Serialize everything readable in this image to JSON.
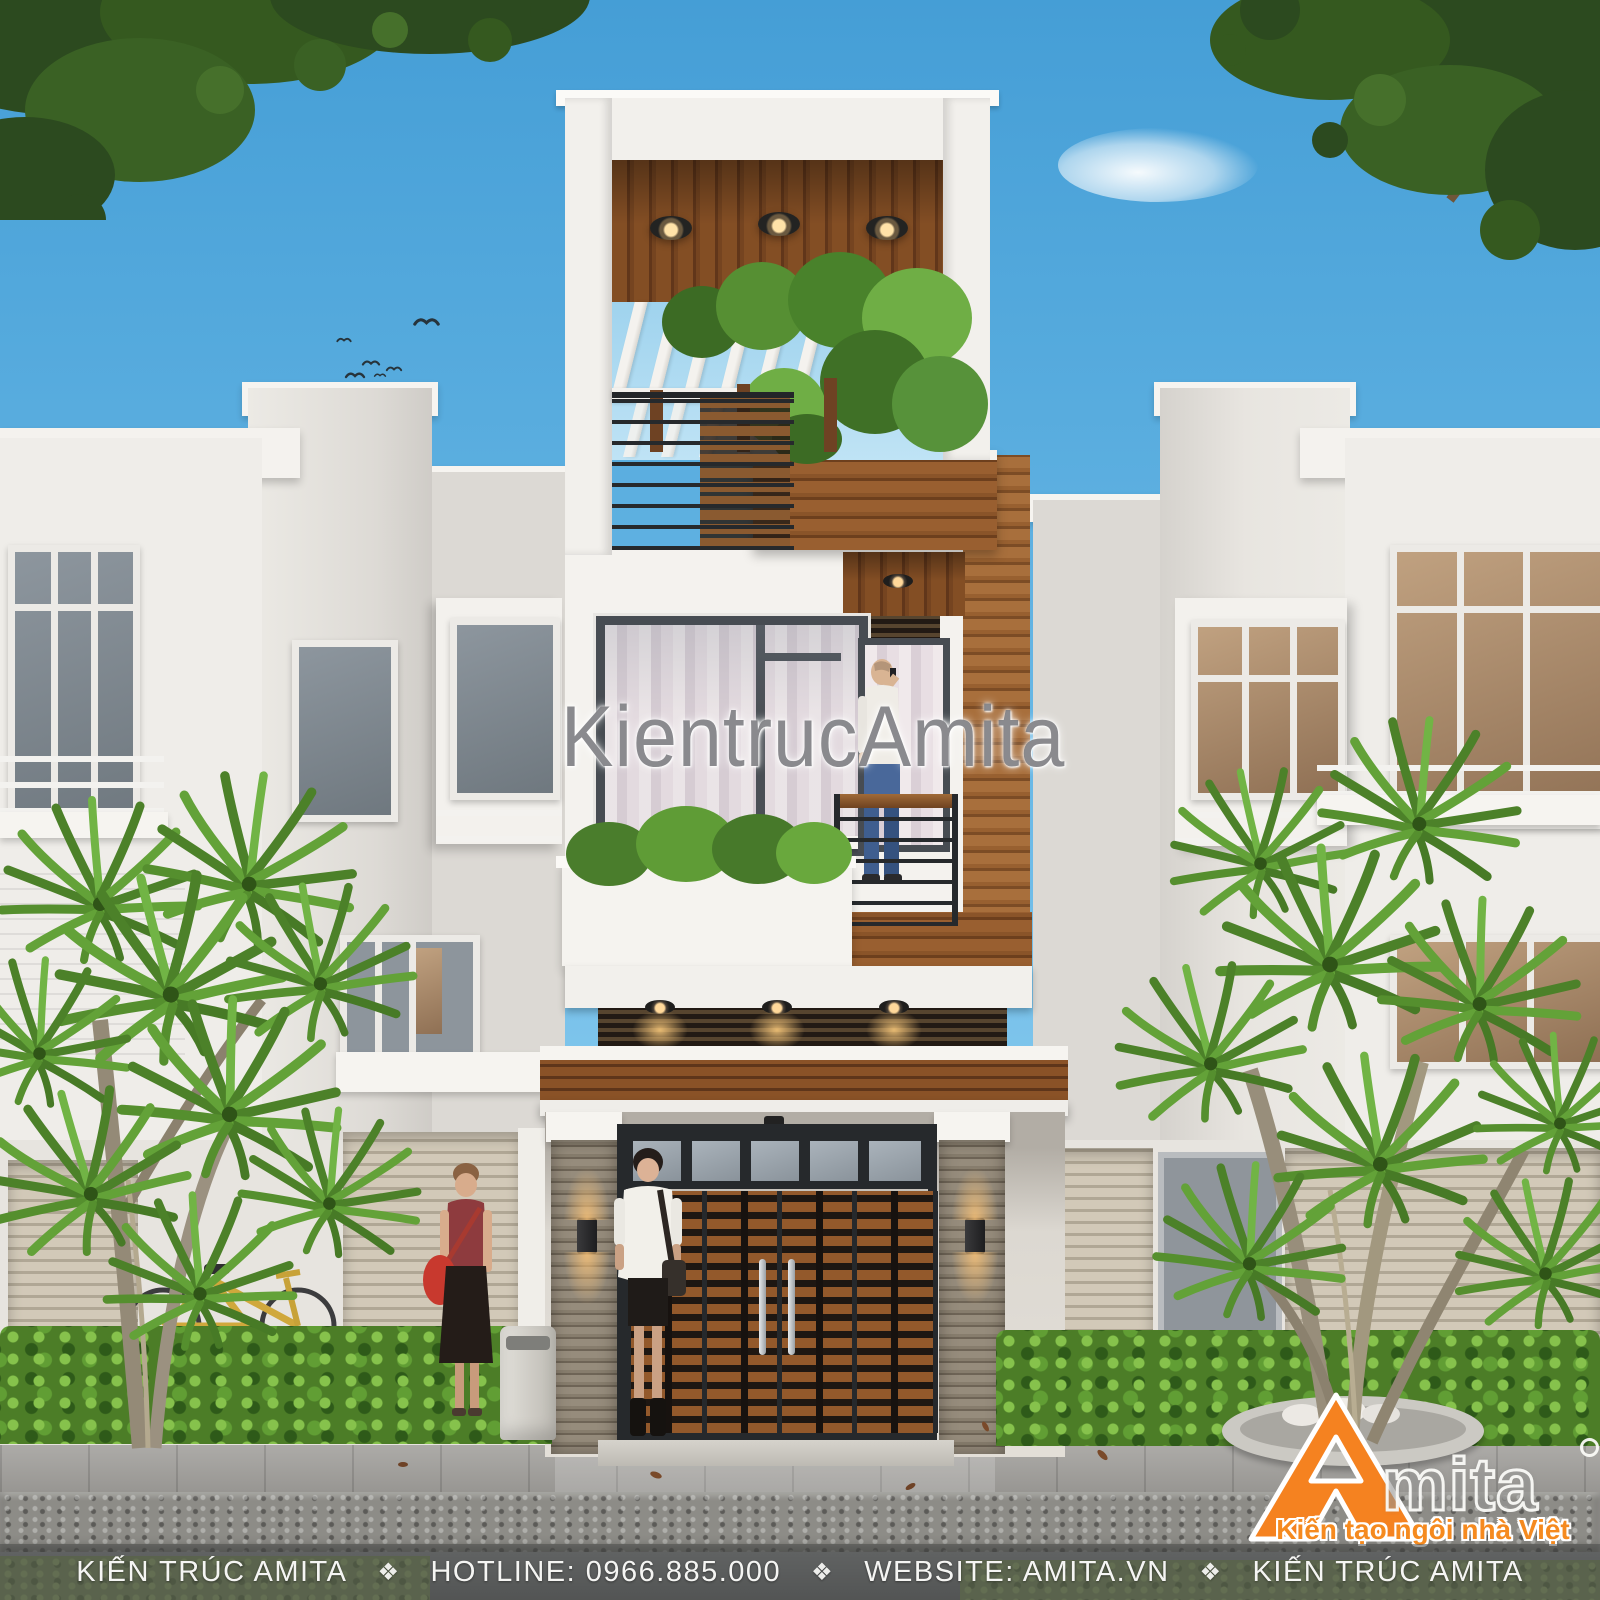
{
  "watermark": {
    "text": "KientrucAmita"
  },
  "footer": {
    "separator": "❖",
    "items": [
      "KIẾN TRÚC AMITA",
      "HOTLINE: 0966.885.000",
      "WEBSITE: AMITA.VN",
      "KIẾN TRÚC AMITA"
    ]
  },
  "logo": {
    "brand_initial": "A",
    "brand_suffix": "mita",
    "tagline": "Kiến tạo ngôi nhà Việt"
  },
  "colors": {
    "accent_orange": "#F58220",
    "sky_blue": "#57ABDF",
    "wood_brown": "#8A5429",
    "foliage_green": "#4C7D27"
  }
}
